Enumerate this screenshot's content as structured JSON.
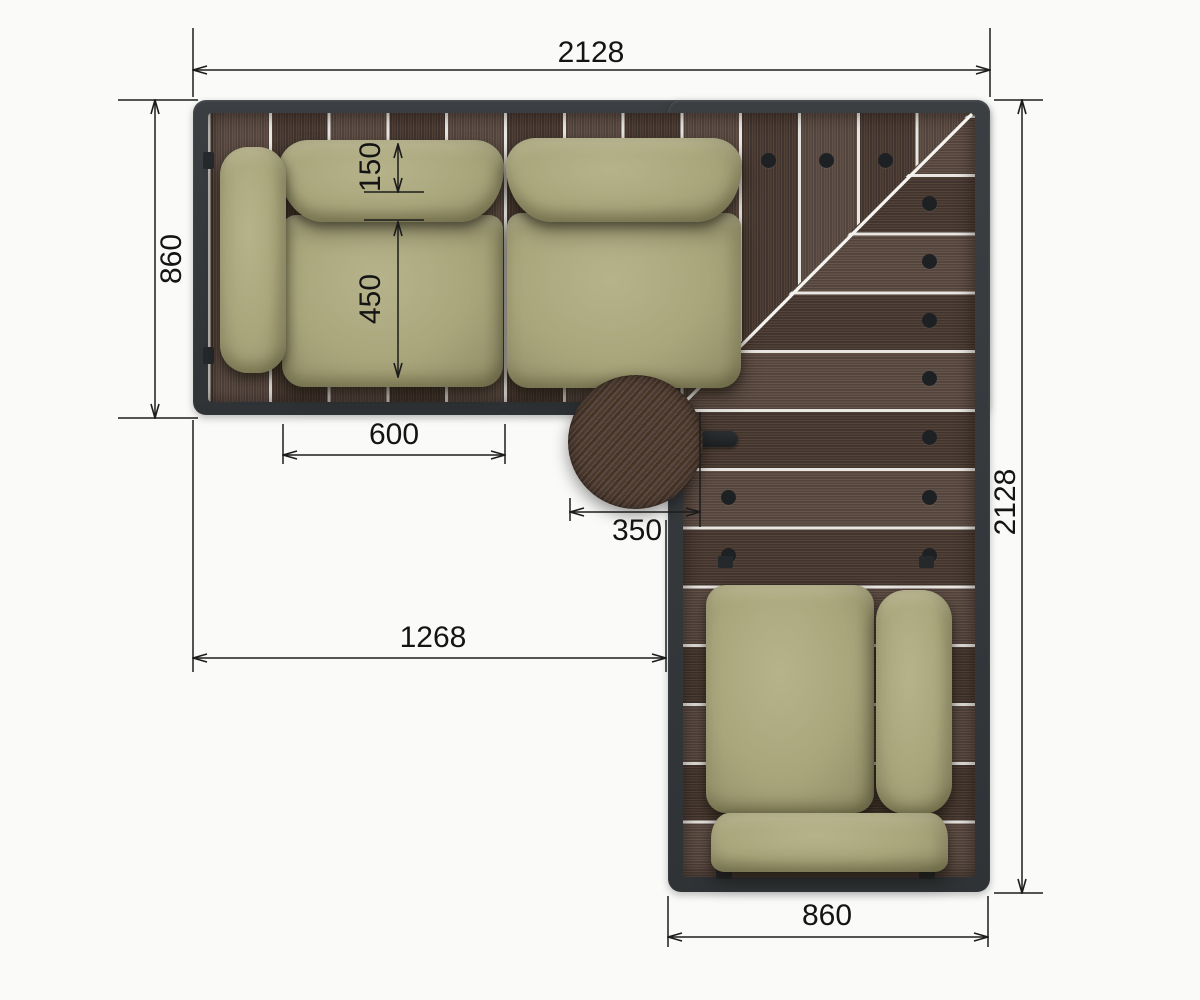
{
  "drawing_type": "top-view furniture dimension drawing",
  "dim_labels": {
    "top_width": "2128",
    "left_depth": "860",
    "backrest_depth": "150",
    "seat_depth": "450",
    "seat_width": "600",
    "table_diameter": "350",
    "inner_width": "1268",
    "right_height": "2128",
    "bottom_width": "860"
  },
  "colors": {
    "background": "#fafaf8",
    "frame": "#33373a",
    "deck_wood": "#4f3e36",
    "plank_gap": "#f6f4f0",
    "cushion": "#a9a57c",
    "table_wood": "#54423a",
    "dimension_line": "#1c1c1c",
    "fastener_dot": "#1e2123"
  }
}
